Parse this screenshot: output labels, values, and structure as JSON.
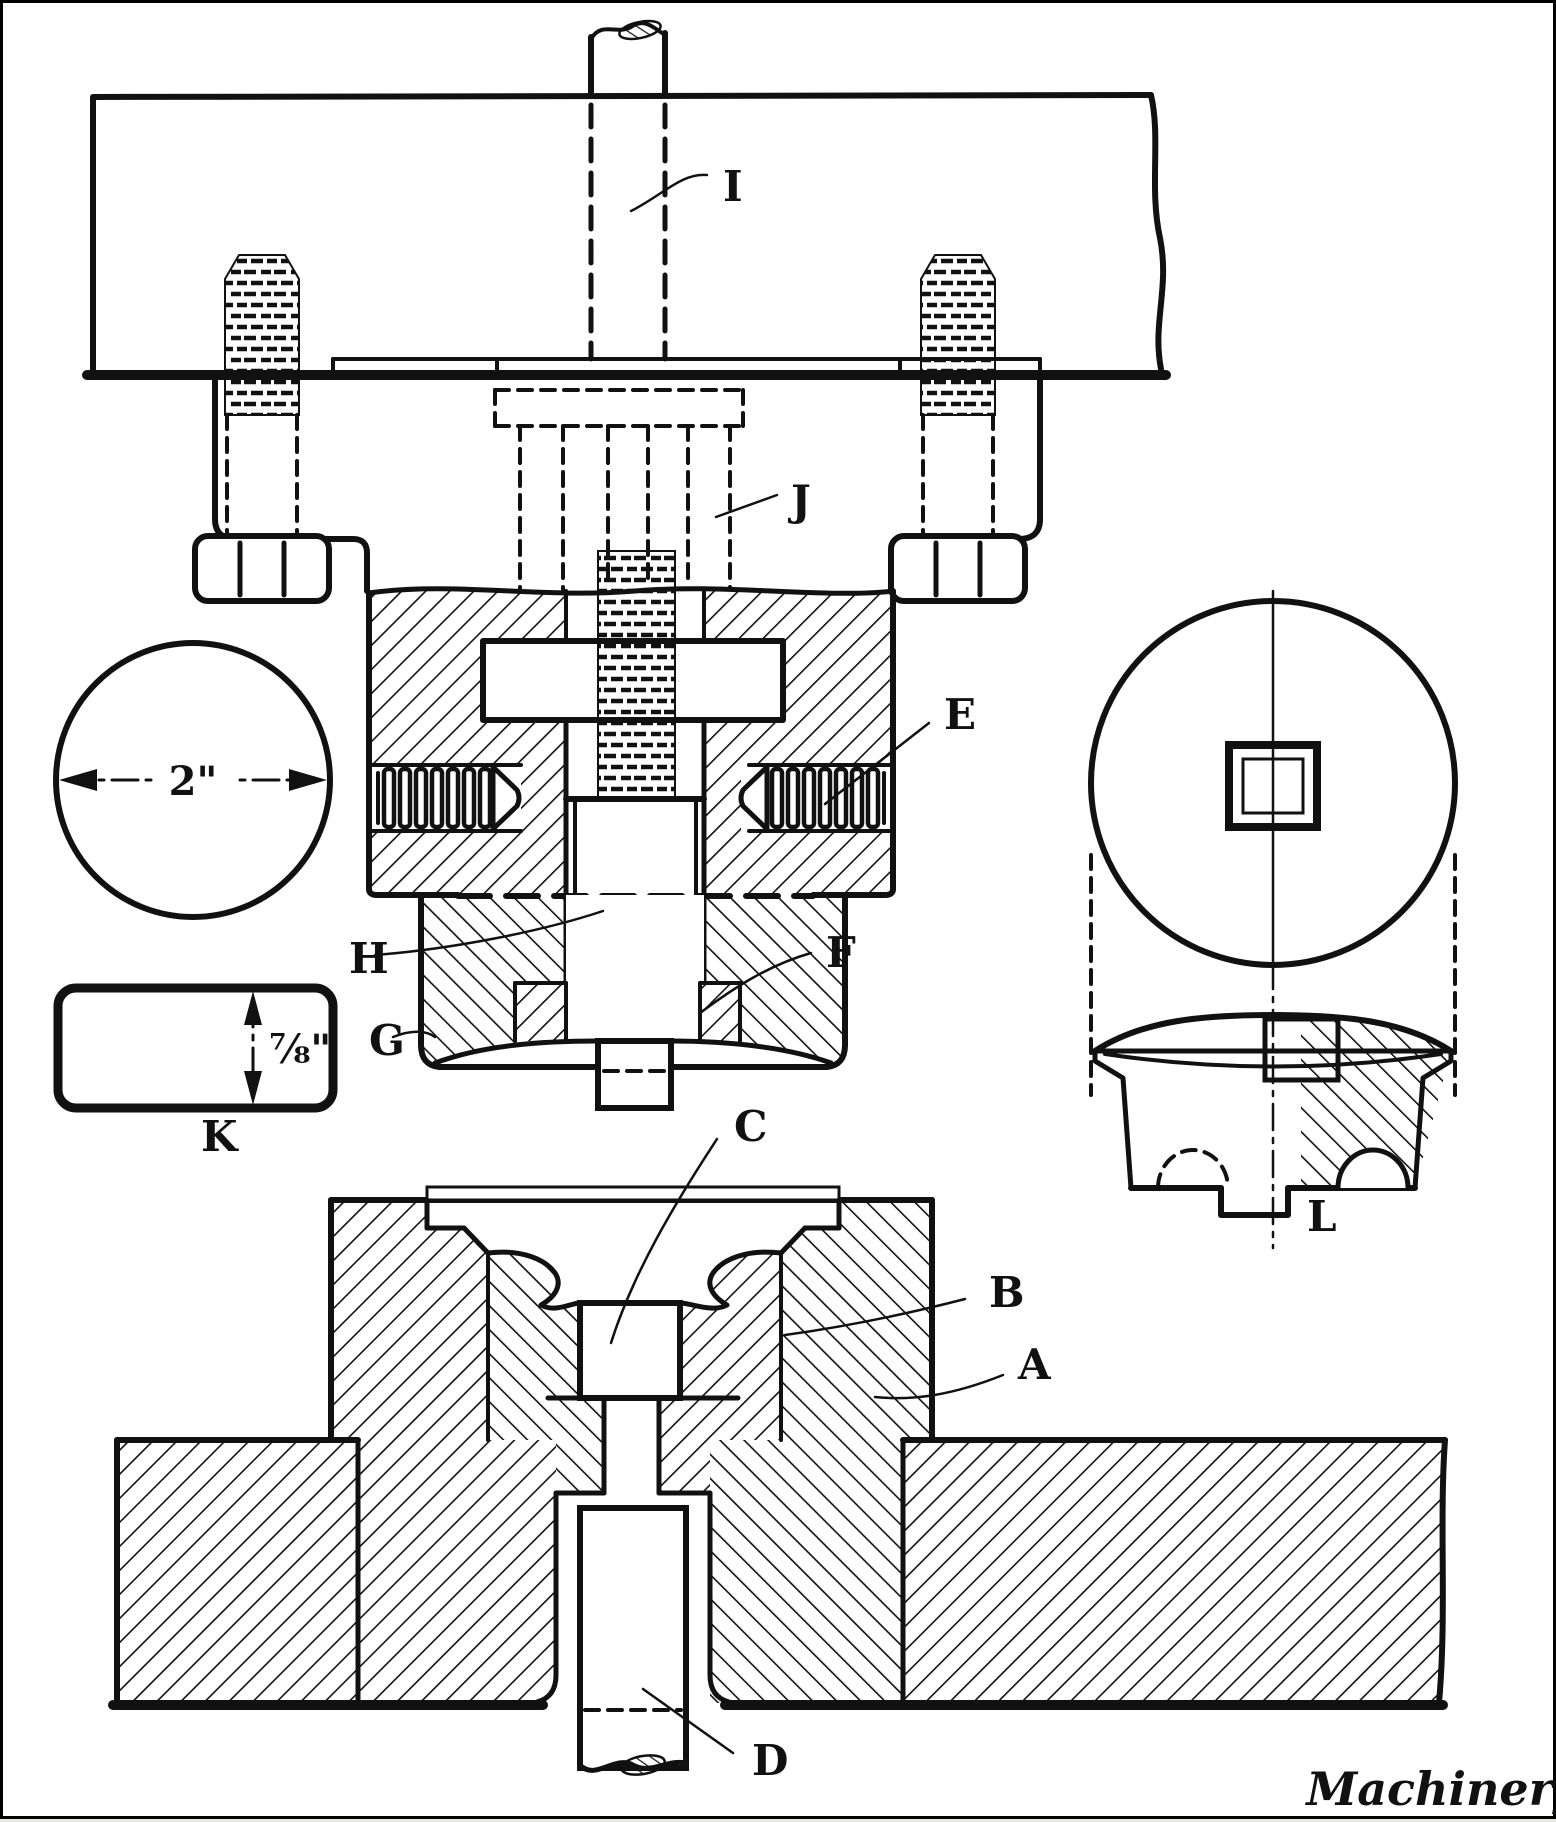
{
  "figure": {
    "background": "#ffffff",
    "ink": "#111111",
    "part_labels": {
      "A": {
        "text": "A",
        "x": 1015,
        "y": 1376
      },
      "B": {
        "text": "B",
        "x": 986,
        "y": 1304
      },
      "C": {
        "text": "C",
        "x": 731,
        "y": 1138
      },
      "D": {
        "text": "D",
        "x": 749,
        "y": 1772
      },
      "E": {
        "text": "E",
        "x": 941,
        "y": 726
      },
      "F": {
        "text": "F",
        "x": 823,
        "y": 964
      },
      "G": {
        "text": "G",
        "x": 366,
        "y": 1052
      },
      "H": {
        "text": "H",
        "x": 346,
        "y": 970
      },
      "I": {
        "text": "I",
        "x": 720,
        "y": 198
      },
      "J": {
        "text": "J",
        "x": 788,
        "y": 512
      },
      "K": {
        "text": "K",
        "x": 198,
        "y": 1148
      },
      "L": {
        "text": "L",
        "x": 1304,
        "y": 1228
      }
    },
    "dimensions": {
      "blank_diameter": {
        "text": "2\"",
        "x": 190,
        "y": 792
      },
      "blank_thickness": {
        "text": "⅞\"",
        "x": 266,
        "y": 1060
      }
    },
    "signature": {
      "text": "Machinery",
      "x": 1440,
      "y": 1802
    }
  }
}
